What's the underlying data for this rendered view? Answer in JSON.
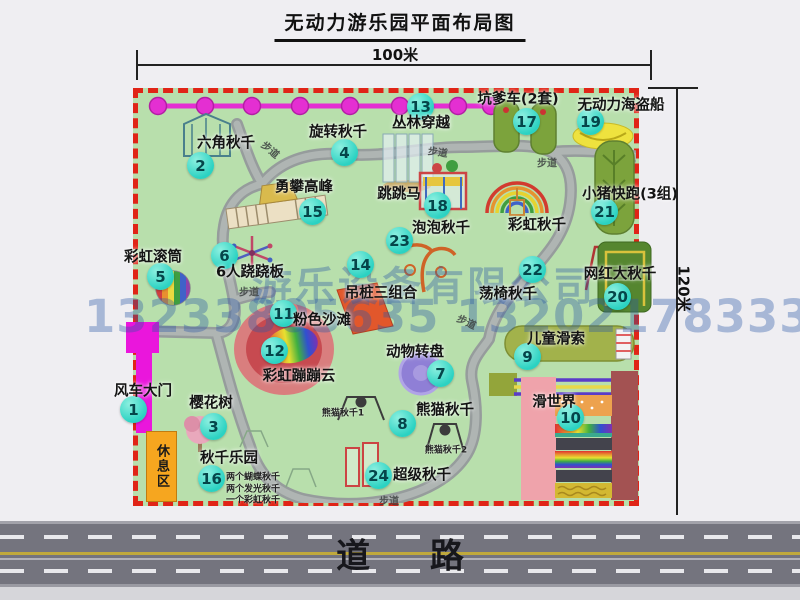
{
  "title": "无动力游乐园平面布局图",
  "dimensions": {
    "top": "100米",
    "right": "120米"
  },
  "road_label": "道 路",
  "rest_area_label": "休息区",
  "watermark": {
    "line1": "游乐设备有限公司",
    "line2": "13233805635 13202178333"
  },
  "colors": {
    "park_green": "#b8dfac",
    "border_red": "#e02417",
    "badge_teal": "#2bd2c2",
    "chain_magenta": "#e42fd2",
    "gate_magenta": "#ea16dc",
    "rest_orange": "#f6a61f",
    "road_gray": "#74747e",
    "road_yellow": "#c0a93c",
    "mat_green": "#7ca33c",
    "mat_dark_green": "#55862f",
    "pirate_yellow": "#eee23e",
    "turntable_purple": "#8f7fd6",
    "beach_pink": "#d97e7e",
    "beach_red": "#c74a50",
    "pile_orange": "#e2572b",
    "watermark_blue": "#2b58a6"
  },
  "attractions": [
    {
      "num": "1",
      "name": "风车大门",
      "bx": 133,
      "by": 409,
      "lx": 143,
      "ly": 390
    },
    {
      "num": "2",
      "name": "六角秋千",
      "bx": 200,
      "by": 165,
      "lx": 226,
      "ly": 142
    },
    {
      "num": "3",
      "name": "樱花树",
      "bx": 213,
      "by": 426,
      "lx": 211,
      "ly": 402
    },
    {
      "num": "4",
      "name": "旋转秋千",
      "bx": 344,
      "by": 152,
      "lx": 338,
      "ly": 131
    },
    {
      "num": "5",
      "name": "彩虹滚筒",
      "bx": 160,
      "by": 276,
      "lx": 153,
      "ly": 256
    },
    {
      "num": "6",
      "name": "6人跷跷板",
      "bx": 224,
      "by": 255,
      "lx": 250,
      "ly": 271
    },
    {
      "num": "7",
      "name": "动物转盘",
      "bx": 440,
      "by": 373,
      "lx": 415,
      "ly": 351
    },
    {
      "num": "8",
      "name": "熊猫秋千",
      "bx": 402,
      "by": 423,
      "lx": 445,
      "ly": 409
    },
    {
      "num": "9",
      "name": "儿童滑索",
      "bx": 527,
      "by": 356,
      "lx": 556,
      "ly": 338
    },
    {
      "num": "10",
      "name": "滑世界",
      "bx": 570,
      "by": 417,
      "lx": 554,
      "ly": 401
    },
    {
      "num": "11",
      "name": "粉色沙滩",
      "bx": 283,
      "by": 313,
      "lx": 322,
      "ly": 319
    },
    {
      "num": "12",
      "name": "彩虹蹦蹦云",
      "bx": 274,
      "by": 350,
      "lx": 299,
      "ly": 375
    },
    {
      "num": "13",
      "name": "丛林穿越",
      "bx": 420,
      "by": 106,
      "lx": 421,
      "ly": 122
    },
    {
      "num": "14",
      "name": "吊桩三组合",
      "bx": 360,
      "by": 264,
      "lx": 381,
      "ly": 292
    },
    {
      "num": "15",
      "name": "勇攀高峰",
      "bx": 312,
      "by": 211,
      "lx": 304,
      "ly": 186
    },
    {
      "num": "16",
      "name": "秋千乐园",
      "bx": 211,
      "by": 478,
      "lx": 229,
      "ly": 457
    },
    {
      "num": "17",
      "name": "坑爹车(2套)",
      "bx": 526,
      "by": 121,
      "lx": 518,
      "ly": 98
    },
    {
      "num": "18",
      "name": "跳跳马",
      "bx": 437,
      "by": 205,
      "lx": 399,
      "ly": 193
    },
    {
      "num": "19",
      "name": "无动力海盗船",
      "bx": 590,
      "by": 121,
      "lx": 621,
      "ly": 104
    },
    {
      "num": "20",
      "name": "网红大秋千",
      "bx": 617,
      "by": 296,
      "lx": 620,
      "ly": 273
    },
    {
      "num": "21",
      "name": "小猪快跑(3组)",
      "bx": 604,
      "by": 211,
      "lx": 630,
      "ly": 193
    },
    {
      "num": "22",
      "name": "荡椅秋千",
      "bx": 532,
      "by": 269,
      "lx": 508,
      "ly": 293
    },
    {
      "num": "23",
      "name": "泡泡秋千",
      "bx": 399,
      "by": 240,
      "lx": 441,
      "ly": 227
    },
    {
      "num": "24",
      "name": "超级秋千",
      "bx": 378,
      "by": 475,
      "lx": 422,
      "ly": 474
    },
    {
      "num": "",
      "name": "彩虹秋千",
      "bx": null,
      "by": null,
      "lx": 537,
      "ly": 224
    }
  ],
  "sub_labels": [
    {
      "text": "熊猫秋千1",
      "x": 343,
      "y": 412
    },
    {
      "text": "熊猫秋千2",
      "x": 446,
      "y": 449
    },
    {
      "text": "两个蝴蝶秋千",
      "x": 253,
      "y": 476
    },
    {
      "text": "两个发光秋千",
      "x": 253,
      "y": 488
    },
    {
      "text": "一个彩虹秋千",
      "x": 253,
      "y": 499
    }
  ],
  "trail": {
    "label": "步道",
    "positions": [
      {
        "x": 271,
        "y": 149,
        "rot": 40
      },
      {
        "x": 438,
        "y": 151,
        "rot": 8
      },
      {
        "x": 547,
        "y": 162,
        "rot": 0
      },
      {
        "x": 249,
        "y": 291,
        "rot": 0
      },
      {
        "x": 467,
        "y": 321,
        "rot": 25
      },
      {
        "x": 389,
        "y": 500,
        "rot": 0
      }
    ]
  }
}
